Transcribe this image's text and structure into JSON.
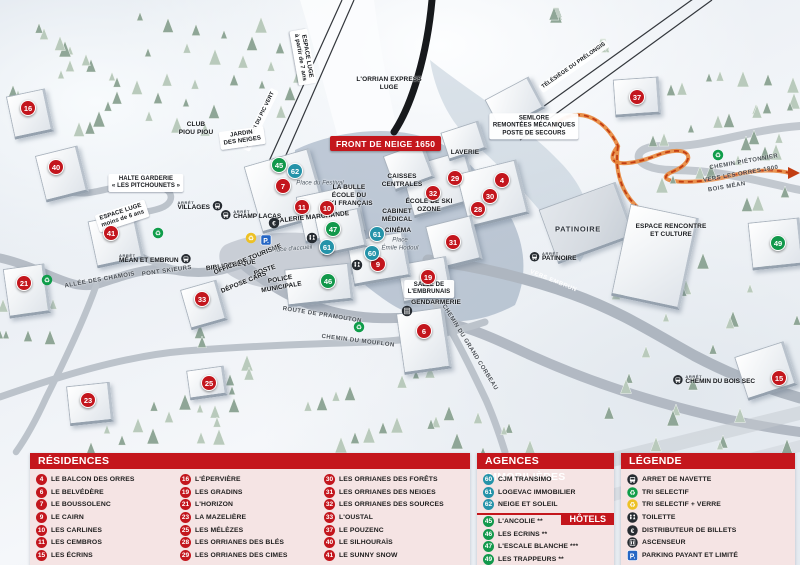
{
  "map": {
    "banner": "FRONT DE NEIGE 1650",
    "stop_prefix": "ARRÊT",
    "colors": {
      "residence": "#c3161d",
      "agency": "#2593a9",
      "hotel": "#12984b",
      "header_red": "#c4161c",
      "panel_bg": "#f5e4e4",
      "path_orange": "#e8863a",
      "parking_blue": "#2566c4"
    },
    "markers": [
      {
        "num": "16",
        "type": "residence",
        "x": 28,
        "y": 108
      },
      {
        "num": "40",
        "type": "residence",
        "x": 56,
        "y": 167
      },
      {
        "num": "41",
        "type": "residence",
        "x": 111,
        "y": 233
      },
      {
        "num": "21",
        "type": "residence",
        "x": 24,
        "y": 283
      },
      {
        "num": "23",
        "type": "residence",
        "x": 88,
        "y": 400
      },
      {
        "num": "33",
        "type": "residence",
        "x": 202,
        "y": 299
      },
      {
        "num": "25",
        "type": "residence",
        "x": 209,
        "y": 383
      },
      {
        "num": "7",
        "type": "residence",
        "x": 283,
        "y": 186
      },
      {
        "num": "11",
        "type": "residence",
        "x": 302,
        "y": 207
      },
      {
        "num": "10",
        "type": "residence",
        "x": 327,
        "y": 208
      },
      {
        "num": "9",
        "type": "residence",
        "x": 378,
        "y": 264
      },
      {
        "num": "19",
        "type": "residence",
        "x": 428,
        "y": 277
      },
      {
        "num": "6",
        "type": "residence",
        "x": 424,
        "y": 331
      },
      {
        "num": "29",
        "type": "residence",
        "x": 455,
        "y": 178
      },
      {
        "num": "32",
        "type": "residence",
        "x": 433,
        "y": 193
      },
      {
        "num": "4",
        "type": "residence",
        "x": 502,
        "y": 180
      },
      {
        "num": "30",
        "type": "residence",
        "x": 490,
        "y": 196
      },
      {
        "num": "28",
        "type": "residence",
        "x": 478,
        "y": 209
      },
      {
        "num": "31",
        "type": "residence",
        "x": 453,
        "y": 242
      },
      {
        "num": "37",
        "type": "residence",
        "x": 637,
        "y": 97
      },
      {
        "num": "15",
        "type": "residence",
        "x": 779,
        "y": 378
      },
      {
        "num": "62",
        "type": "agency",
        "x": 295,
        "y": 171
      },
      {
        "num": "61",
        "type": "agency",
        "x": 377,
        "y": 234
      },
      {
        "num": "61",
        "type": "agency",
        "x": 327,
        "y": 247
      },
      {
        "num": "60",
        "type": "agency",
        "x": 372,
        "y": 253
      },
      {
        "num": "45",
        "type": "hotel",
        "x": 279,
        "y": 165
      },
      {
        "num": "47",
        "type": "hotel",
        "x": 333,
        "y": 229
      },
      {
        "num": "46",
        "type": "hotel",
        "x": 328,
        "y": 281
      },
      {
        "num": "49",
        "type": "hotel",
        "x": 778,
        "y": 243
      }
    ],
    "labels": [
      {
        "t": "ESPACE LUGE\nà partir de 7 ans",
        "x": 303,
        "y": 57,
        "r": 80,
        "v": "chip"
      },
      {
        "t": "TÉLÉSKI DU PIC VERT",
        "x": 260,
        "y": 120,
        "r": -64,
        "v": "lift"
      },
      {
        "t": "L'ORRIAN EXPRESS\nLUGE",
        "x": 389,
        "y": 84,
        "r": 0
      },
      {
        "t": "TÉLÉSIÈGE DU PRÉLONGIS",
        "x": 574,
        "y": 66,
        "r": -35,
        "v": "lift"
      },
      {
        "t": "SEMLORE\nREMONTÉES MÉCANIQUES\nPOSTE DE SECOURS",
        "x": 534,
        "y": 126,
        "r": 0,
        "v": "chip"
      },
      {
        "t": "CLUB\nPIOU PIOU",
        "x": 196,
        "y": 129,
        "r": 0
      },
      {
        "t": "JARDIN\nDES NEIGES",
        "x": 242,
        "y": 138,
        "r": -8,
        "v": "chip"
      },
      {
        "t": "HALTE GARDERIE\n« LES PITCHOUNETS »",
        "x": 146,
        "y": 183,
        "r": 0,
        "v": "chip"
      },
      {
        "t": "ESPACE LUGE\nmoins de 6 ans",
        "x": 122,
        "y": 216,
        "r": -18,
        "v": "chip"
      },
      {
        "t": "Place du Festival",
        "x": 320,
        "y": 184,
        "r": 0,
        "v": "place"
      },
      {
        "t": "LA BULLE\nÉCOLE DU\nSKI FRANÇAIS",
        "x": 349,
        "y": 196,
        "r": 0
      },
      {
        "t": "GALERIE MARCHANDE",
        "x": 312,
        "y": 218,
        "r": -6
      },
      {
        "t": "CAISSES\nCENTRALES",
        "x": 402,
        "y": 181,
        "r": 0
      },
      {
        "t": "LAVERIE",
        "x": 465,
        "y": 153,
        "r": 0
      },
      {
        "t": "ÉCOLE DE SKI\nOZONE",
        "x": 429,
        "y": 206,
        "r": 0
      },
      {
        "t": "CABINET\nMÉDICAL",
        "x": 397,
        "y": 216,
        "r": 0
      },
      {
        "t": "CINÉMA",
        "x": 398,
        "y": 231,
        "r": 0
      },
      {
        "t": "Place\nÉmile Hodoul",
        "x": 400,
        "y": 245,
        "r": 0,
        "v": "place"
      },
      {
        "t": "BIBLIOTHÈQUE",
        "x": 231,
        "y": 266,
        "r": -8
      },
      {
        "t": "OFFICE DE TOURISME",
        "x": 248,
        "y": 260,
        "r": -22
      },
      {
        "t": "POSTE",
        "x": 265,
        "y": 271,
        "r": -18
      },
      {
        "t": "POLICE\nMUNICIPALE",
        "x": 281,
        "y": 284,
        "r": -10
      },
      {
        "t": "DÉPOSE CARS",
        "x": 244,
        "y": 283,
        "r": -22
      },
      {
        "t": "Place d'accueil",
        "x": 292,
        "y": 250,
        "r": -5,
        "v": "place"
      },
      {
        "t": "SALLE DE\nL'EMBRUNAIS",
        "x": 429,
        "y": 289,
        "r": 0,
        "v": "chip"
      },
      {
        "t": "GENDARMERIE",
        "x": 436,
        "y": 303,
        "r": 0
      },
      {
        "t": "PATINOIRE",
        "x": 578,
        "y": 229,
        "r": 0,
        "v": "big"
      },
      {
        "t": "ESPACE RENCONTRE\nET CULTURE",
        "x": 671,
        "y": 231,
        "r": 0
      },
      {
        "t": "ALLÉE DES CHAMOIS",
        "x": 100,
        "y": 281,
        "r": -10,
        "v": "road"
      },
      {
        "t": "PONT SKIEURS",
        "x": 167,
        "y": 272,
        "r": -8,
        "v": "road"
      },
      {
        "t": "ROUTE DE PRAMOUTON",
        "x": 322,
        "y": 316,
        "r": 9,
        "v": "road"
      },
      {
        "t": "CHEMIN DU MOUFLON",
        "x": 358,
        "y": 342,
        "r": 7,
        "v": "road"
      },
      {
        "t": "CHEMIN DU GRAND CORBEAU",
        "x": 469,
        "y": 348,
        "r": 58,
        "v": "road"
      },
      {
        "t": "VERS EMBRUN",
        "x": 553,
        "y": 282,
        "r": 22,
        "v": "roadwhite"
      },
      {
        "t": "CHEMIN PIÉTONNIER",
        "x": 744,
        "y": 163,
        "r": -10,
        "v": "road"
      },
      {
        "t": "VERS LES ORRES 1800",
        "x": 741,
        "y": 175,
        "r": -10,
        "v": "road"
      },
      {
        "t": "BOIS MÉAN",
        "x": 727,
        "y": 188,
        "r": -10,
        "v": "road"
      }
    ],
    "bus_stops": [
      {
        "name": "VILLAGES",
        "x": 200,
        "y": 206,
        "icon_side": "right"
      },
      {
        "name": "CHAMP LACAS",
        "x": 251,
        "y": 215,
        "icon_side": "left"
      },
      {
        "name": "MÉAN ET EMBRUN",
        "x": 155,
        "y": 259,
        "icon_side": "right"
      },
      {
        "name": "PATINOIRE",
        "x": 553,
        "y": 257,
        "icon_side": "left"
      },
      {
        "name": "CHEMIN DU BOIS SEC",
        "x": 714,
        "y": 380,
        "icon_side": "left"
      }
    ],
    "icons": [
      {
        "icon": "recycle-green-icon",
        "x": 47,
        "y": 280
      },
      {
        "icon": "recycle-green-icon",
        "x": 158,
        "y": 233
      },
      {
        "icon": "recycle-green-icon",
        "x": 359,
        "y": 327
      },
      {
        "icon": "recycle-green-icon",
        "x": 718,
        "y": 155
      },
      {
        "icon": "recycle-yellow-icon",
        "x": 251,
        "y": 238
      },
      {
        "icon": "atm-icon",
        "x": 274,
        "y": 223
      },
      {
        "icon": "toilets-icon",
        "x": 312,
        "y": 238
      },
      {
        "icon": "toilets-icon",
        "x": 357,
        "y": 265
      },
      {
        "icon": "elevator-icon",
        "x": 407,
        "y": 311
      },
      {
        "icon": "parking-icon",
        "x": 266,
        "y": 240
      }
    ]
  },
  "panels": {
    "residences": {
      "title": "RÉSIDENCES",
      "items": [
        {
          "num": "4",
          "label": "LE BALCON DES ORRES"
        },
        {
          "num": "6",
          "label": "LE BELVÉDÈRE"
        },
        {
          "num": "7",
          "label": "LE BOUSSOLENC"
        },
        {
          "num": "9",
          "label": "LE CAIRN"
        },
        {
          "num": "10",
          "label": "LES CARLINES"
        },
        {
          "num": "11",
          "label": "LES CEMBROS"
        },
        {
          "num": "15",
          "label": "LES ÉCRINS"
        },
        {
          "num": "16",
          "label": "L'ÉPERVIÈRE"
        },
        {
          "num": "19",
          "label": "LES GRADINS"
        },
        {
          "num": "21",
          "label": "L'HORIZON"
        },
        {
          "num": "23",
          "label": "LA MAZELIÈRE"
        },
        {
          "num": "25",
          "label": "LES MÉLÈZES"
        },
        {
          "num": "28",
          "label": "LES ORRIANES DES BLÉS"
        },
        {
          "num": "29",
          "label": "LES ORRIANES DES CIMES"
        },
        {
          "num": "30",
          "label": "LES ORRIANES DES FORÊTS"
        },
        {
          "num": "31",
          "label": "LES ORRIANES DES NEIGES"
        },
        {
          "num": "32",
          "label": "LES ORRIANES DES SOURCES"
        },
        {
          "num": "33",
          "label": "L'OUSTAL"
        },
        {
          "num": "37",
          "label": "LE POUZENC"
        },
        {
          "num": "40",
          "label": "LE SILHOURAÏS"
        },
        {
          "num": "41",
          "label": "LE SUNNY SNOW"
        }
      ]
    },
    "agences": {
      "title": "AGENCES IMMOBILIÈRES",
      "items": [
        {
          "num": "60",
          "label": "CJM TRANSIMO"
        },
        {
          "num": "61",
          "label": "LOGEVAC IMMOBILIER"
        },
        {
          "num": "62",
          "label": "NEIGE ET SOLEIL"
        }
      ]
    },
    "hotels": {
      "title": "HÔTELS",
      "items": [
        {
          "num": "45",
          "label": "L'ANCOLIE **"
        },
        {
          "num": "46",
          "label": "LES ECRINS **"
        },
        {
          "num": "47",
          "label": "L'ESCALE BLANCHE ***"
        },
        {
          "num": "49",
          "label": "LES TRAPPEURS **"
        }
      ]
    },
    "legende": {
      "title": "LÉGENDE",
      "items": [
        {
          "icon": "bus-icon",
          "label": "ARRET DE NAVETTE"
        },
        {
          "icon": "recycle-green-icon",
          "label": "TRI SELECTIF"
        },
        {
          "icon": "recycle-yellow-icon",
          "label": "TRI SELECTIF + VERRE"
        },
        {
          "icon": "toilets-icon",
          "label": "TOILETTE"
        },
        {
          "icon": "atm-icon",
          "label": "DISTRIBUTEUR DE BILLETS"
        },
        {
          "icon": "elevator-icon",
          "label": "ASCENSEUR"
        },
        {
          "icon": "parking-icon",
          "label": "PARKING PAYANT ET LIMITÉ"
        }
      ]
    }
  }
}
